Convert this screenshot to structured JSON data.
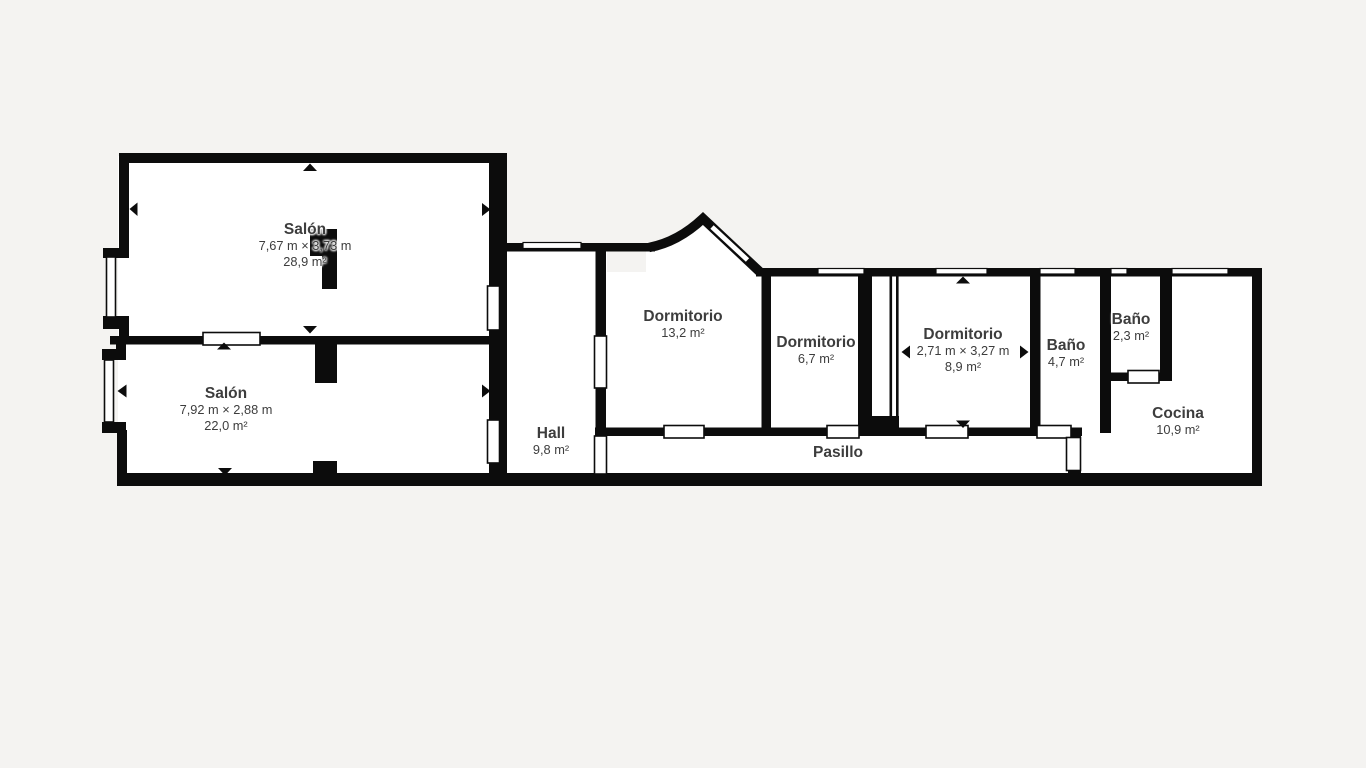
{
  "plan": {
    "type": "floor-plan",
    "language": "es"
  },
  "colors": {
    "bg": "#f4f3f1",
    "wall": "#0c0c0c",
    "floor": "#ffffff",
    "ink": "#3d3d3d"
  },
  "rooms": [
    {
      "id": "salon-1",
      "name": "Salón",
      "dims": "7,67 m × 3,73 m",
      "area": "28,9 m²"
    },
    {
      "id": "salon-2",
      "name": "Salón",
      "dims": "7,92 m × 2,88 m",
      "area": "22,0 m²"
    },
    {
      "id": "hall",
      "name": "Hall",
      "area": "9,8 m²"
    },
    {
      "id": "dormitorio-1",
      "name": "Dormitorio",
      "area": "13,2 m²"
    },
    {
      "id": "dormitorio-2",
      "name": "Dormitorio",
      "area": "6,7 m²"
    },
    {
      "id": "dormitorio-3",
      "name": "Dormitorio",
      "dims": "2,71 m × 3,27 m",
      "area": "8,9 m²"
    },
    {
      "id": "bano-1",
      "name": "Baño",
      "area": "4,7 m²"
    },
    {
      "id": "bano-2",
      "name": "Baño",
      "area": "2,3 m²"
    },
    {
      "id": "cocina",
      "name": "Cocina",
      "area": "10,9 m²"
    },
    {
      "id": "pasillo",
      "name": "Pasillo"
    }
  ]
}
